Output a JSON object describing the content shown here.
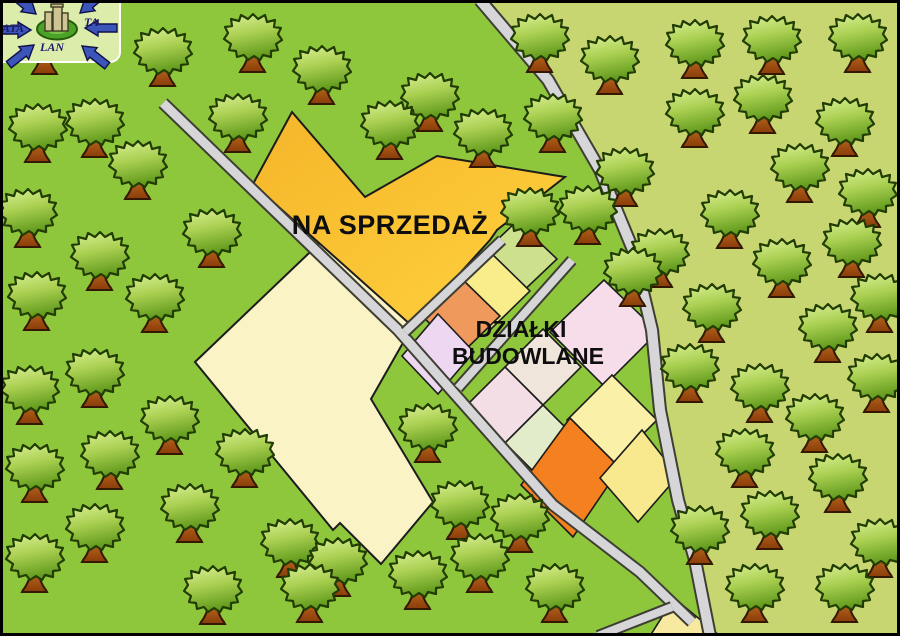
{
  "page": {
    "title": "Mapa działek na sprzedaż"
  },
  "labels": {
    "na_sprzedaz": "NA SPRZEDAŻ",
    "dzialki_line1": "DZIAŁKI",
    "dzialki_line2": "BUDOWLANE"
  },
  "logo": {
    "text_left": "ATA",
    "text_right": "TA",
    "text_bottom": "LAN"
  },
  "colors": {
    "grass": "#8ec73b",
    "grass_light": "#c8d672",
    "road_fill": "#d6d6d8",
    "road_casing": "#3e3e34",
    "outline": "#1c1c1c",
    "frame": "#000000",
    "gold_dark": "#f5b52a",
    "gold_light": "#ffd23e",
    "logo_tile": "#dcecaa",
    "logo_arrow": "#3b55b8",
    "logo_arrow_edge": "#10104a",
    "logo_ring": "#4aa227",
    "logo_ring_edge": "#235c0e",
    "logo_building": "#cfc493",
    "logo_text": "#1b1b70"
  },
  "map": {
    "width": 900,
    "height": 636,
    "light_region": [
      [
        480,
        0
      ],
      [
        548,
        80
      ],
      [
        600,
        170
      ],
      [
        633,
        250
      ],
      [
        652,
        330
      ],
      [
        660,
        410
      ],
      [
        678,
        500
      ],
      [
        695,
        560
      ],
      [
        710,
        636
      ],
      [
        900,
        636
      ],
      [
        900,
        0
      ]
    ],
    "plots": [
      {
        "name": "plot-cream-large",
        "color": "#faf3c6",
        "stroke": 2,
        "points": [
          [
            330,
            233
          ],
          [
            412,
            327
          ],
          [
            371,
            399
          ],
          [
            433,
            502
          ],
          [
            381,
            564
          ],
          [
            340,
            523
          ],
          [
            333,
            530
          ],
          [
            195,
            362
          ]
        ]
      },
      {
        "name": "plot-na-sprzedaz",
        "color": "url(#goldGrad)",
        "stroke": 2,
        "points": [
          [
            292,
            112
          ],
          [
            365,
            197
          ],
          [
            437,
            156
          ],
          [
            565,
            177
          ],
          [
            497,
            230
          ],
          [
            490,
            240
          ],
          [
            412,
            326
          ],
          [
            253,
            184
          ]
        ]
      },
      {
        "name": "parcel-light-green",
        "color": "#cde08e",
        "points": [
          [
            517,
            221
          ],
          [
            557,
            259
          ],
          [
            517,
            297
          ],
          [
            477,
            259
          ]
        ]
      },
      {
        "name": "parcel-yellow",
        "color": "#f8ec8b",
        "points": [
          [
            491,
            253
          ],
          [
            530,
            291
          ],
          [
            491,
            329
          ],
          [
            452,
            291
          ]
        ]
      },
      {
        "name": "parcel-orange",
        "color": "#f0995c",
        "points": [
          [
            461,
            278
          ],
          [
            500,
            316
          ],
          [
            461,
            354
          ],
          [
            422,
            316
          ]
        ]
      },
      {
        "name": "parcel-lavender",
        "color": "#eed7f0",
        "points": [
          [
            438,
            314
          ],
          [
            474,
            352
          ],
          [
            438,
            394
          ],
          [
            402,
            356
          ]
        ]
      },
      {
        "name": "parcel-pink-large",
        "color": "#f7dcea",
        "points": [
          [
            604,
            280
          ],
          [
            658,
            332
          ],
          [
            604,
            386
          ],
          [
            550,
            332
          ]
        ]
      },
      {
        "name": "parcel-pale-cream",
        "color": "#efe5da",
        "points": [
          [
            543,
            329
          ],
          [
            581,
            367
          ],
          [
            543,
            405
          ],
          [
            505,
            367
          ]
        ]
      },
      {
        "name": "parcel-pale-pink",
        "color": "#f4dee6",
        "points": [
          [
            505,
            367
          ],
          [
            543,
            405
          ],
          [
            505,
            443
          ],
          [
            467,
            405
          ]
        ]
      },
      {
        "name": "parcel-pale-green",
        "color": "#e2ecca",
        "points": [
          [
            543,
            405
          ],
          [
            581,
            443
          ],
          [
            543,
            481
          ],
          [
            505,
            443
          ]
        ]
      },
      {
        "name": "parcel-pale-yellow",
        "color": "#faf0a8",
        "points": [
          [
            612,
            375
          ],
          [
            657,
            420
          ],
          [
            612,
            465
          ],
          [
            567,
            420
          ]
        ]
      },
      {
        "name": "parcel-bright-orange",
        "color": "#f5801f",
        "points": [
          [
            570,
            418
          ],
          [
            620,
            468
          ],
          [
            573,
            537
          ],
          [
            521,
            485
          ]
        ]
      },
      {
        "name": "parcel-yellow-right",
        "color": "#f8e88e",
        "points": [
          [
            642,
            430
          ],
          [
            678,
            476
          ],
          [
            638,
            522
          ],
          [
            600,
            478
          ]
        ]
      },
      {
        "name": "parcel-junction-triangle",
        "color": "#f7e9a0",
        "points": [
          [
            674,
            598
          ],
          [
            720,
            636
          ],
          [
            650,
            636
          ]
        ]
      }
    ],
    "roads": [
      {
        "name": "road-main-diagonal",
        "width": 9,
        "points": [
          [
            163,
            103
          ],
          [
            398,
            330
          ],
          [
            553,
            505
          ],
          [
            640,
            572
          ],
          [
            692,
            622
          ]
        ]
      },
      {
        "name": "road-east-curve",
        "width": 10,
        "points": [
          [
            480,
            0
          ],
          [
            548,
            80
          ],
          [
            600,
            170
          ],
          [
            633,
            250
          ],
          [
            652,
            330
          ],
          [
            660,
            410
          ],
          [
            678,
            500
          ],
          [
            695,
            560
          ],
          [
            710,
            636
          ]
        ]
      },
      {
        "name": "street-parcels-center",
        "width": 8,
        "points": [
          [
            572,
            260
          ],
          [
            458,
            388
          ]
        ]
      },
      {
        "name": "street-parcels-upper",
        "width": 8,
        "points": [
          [
            502,
            240
          ],
          [
            405,
            332
          ]
        ]
      },
      {
        "name": "road-bottom-branch",
        "width": 8,
        "points": [
          [
            672,
            607
          ],
          [
            598,
            636
          ]
        ]
      }
    ],
    "trees": [
      [
        45,
        40
      ],
      [
        163,
        52
      ],
      [
        253,
        38
      ],
      [
        322,
        70
      ],
      [
        430,
        97
      ],
      [
        390,
        125
      ],
      [
        540,
        38
      ],
      [
        610,
        60
      ],
      [
        695,
        44
      ],
      [
        772,
        40
      ],
      [
        858,
        38
      ],
      [
        38,
        128
      ],
      [
        95,
        123
      ],
      [
        238,
        118
      ],
      [
        483,
        133
      ],
      [
        553,
        118
      ],
      [
        138,
        165
      ],
      [
        28,
        213
      ],
      [
        212,
        233
      ],
      [
        100,
        256
      ],
      [
        530,
        212
      ],
      [
        625,
        172
      ],
      [
        695,
        113
      ],
      [
        763,
        99
      ],
      [
        845,
        122
      ],
      [
        800,
        168
      ],
      [
        868,
        193
      ],
      [
        588,
        210
      ],
      [
        660,
        253
      ],
      [
        730,
        214
      ],
      [
        852,
        243
      ],
      [
        37,
        296
      ],
      [
        155,
        298
      ],
      [
        633,
        272
      ],
      [
        712,
        308
      ],
      [
        782,
        263
      ],
      [
        880,
        298
      ],
      [
        95,
        373
      ],
      [
        30,
        390
      ],
      [
        428,
        428
      ],
      [
        690,
        368
      ],
      [
        760,
        388
      ],
      [
        828,
        328
      ],
      [
        877,
        378
      ],
      [
        170,
        420
      ],
      [
        110,
        455
      ],
      [
        245,
        453
      ],
      [
        35,
        468
      ],
      [
        460,
        505
      ],
      [
        520,
        518
      ],
      [
        815,
        418
      ],
      [
        745,
        453
      ],
      [
        838,
        478
      ],
      [
        700,
        530
      ],
      [
        770,
        515
      ],
      [
        880,
        543
      ],
      [
        95,
        528
      ],
      [
        190,
        508
      ],
      [
        290,
        543
      ],
      [
        35,
        558
      ],
      [
        338,
        562
      ],
      [
        213,
        590
      ],
      [
        310,
        588
      ],
      [
        418,
        575
      ],
      [
        480,
        558
      ],
      [
        555,
        588
      ],
      [
        755,
        588
      ],
      [
        845,
        588
      ]
    ]
  }
}
